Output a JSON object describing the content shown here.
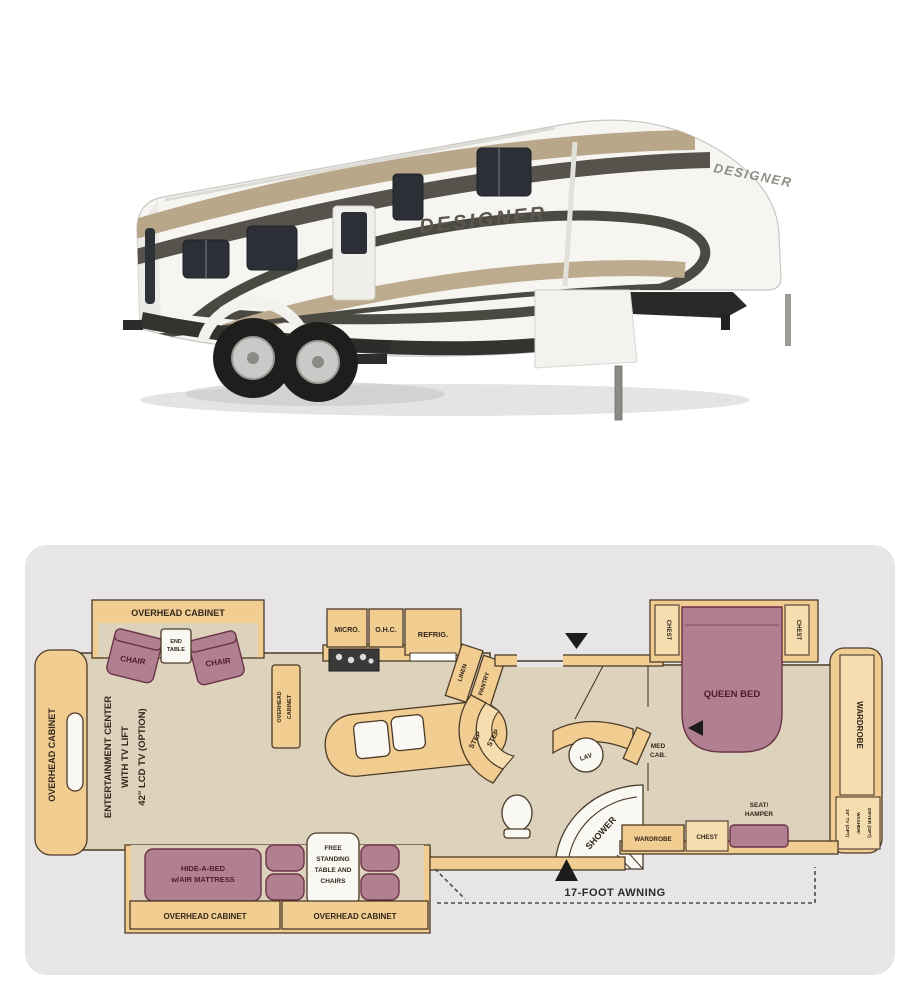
{
  "photo": {
    "description": "white fifth-wheel travel trailer, side view facing right",
    "brand_side": "DESIGNER",
    "brand_front": "DESIGNER",
    "colors": {
      "body": "#f6f5f2",
      "swoosh_dark": "#4b4a42",
      "swoosh_tan": "#b5a284",
      "skirt": "#35332f",
      "window": "#2c3036",
      "shadow": "#d9d9d9"
    }
  },
  "floorplan": {
    "card_bg": "#e7e5e6",
    "colors": {
      "cabinet": "#f2cd92",
      "cabinet_light": "#f5ddb0",
      "floor": "#ddd2bc",
      "furniture": "#b07f90",
      "furniture_outline": "#6b3347",
      "outline": "#4a3a28",
      "label": "#32271a",
      "furniture_label": "#4a1c2c"
    },
    "labels": {
      "overhead_cabinet": "OVERHEAD CABINET",
      "overhead_2line": [
        "OVERHEAD",
        "CABINET"
      ],
      "chair": "CHAIR",
      "end_table": [
        "END",
        "TABLE"
      ],
      "entertainment_center": [
        "ENTERTAINMENT CENTER",
        "WITH TV LIFT",
        "42\" LCD TV (OPTION)"
      ],
      "micro": "MICRO.",
      "ohc": "O.H.C.",
      "refrig": "REFRIG.",
      "linen": "LINEN",
      "pantry": "PANTRY",
      "step": "STEP",
      "lav": "LAV",
      "med_cab": [
        "MED",
        "CAB."
      ],
      "shower": "SHOWER",
      "queen_bed": "QUEEN BED",
      "chest": "CHEST",
      "wardrobe": "WARDROBE",
      "seat_hamper": [
        "SEAT/",
        "HAMPER"
      ],
      "corner_options": [
        "19\" TV (OPT)",
        "WASHER/",
        "DRYER (OPT)"
      ],
      "hide_a_bed": [
        "HIDE-A-BED",
        "w/AIR MATTRESS"
      ],
      "free_standing": [
        "FREE",
        "STANDING",
        "TABLE AND",
        "CHAIRS"
      ],
      "awning": "17-FOOT AWNING"
    }
  }
}
